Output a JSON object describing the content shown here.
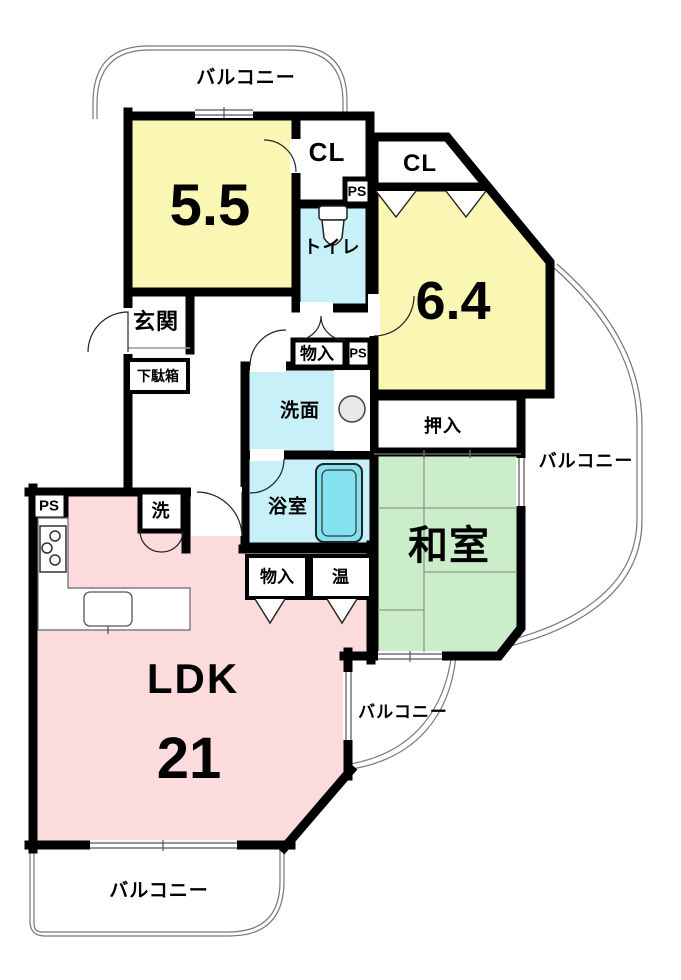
{
  "colors": {
    "room_yellow": "#FAF6B4",
    "room_cyan": "#C7F0F8",
    "room_green": "#CBEDCA",
    "room_pink": "#FBDBDB",
    "tub_cyan": "#84E1EF",
    "appliance_gray": "#E8E8E8",
    "wall_black": "#000000",
    "outline_gray": "#777777"
  },
  "labels": {
    "balcony_top": "バルコニー",
    "balcony_right": "バルコニー",
    "balcony_mid": "バルコニー",
    "balcony_bottom": "バルコニー",
    "room_5_5": "5.5",
    "room_6_4": "6.4",
    "cl_1": "CL",
    "cl_2": "CL",
    "ps_top": "PS",
    "ps_hall": "PS",
    "ps_kitchen": "PS",
    "toilet": "トイレ",
    "genkan": "玄関",
    "getabako": "下駄箱",
    "monoire_hall": "物入",
    "senmen": "洗面",
    "oshiire": "押入",
    "yokushitsu": "浴室",
    "washitsu": "和室",
    "laundry": "洗",
    "monoire_ldk": "物入",
    "water_heater": "温",
    "ldk": "LDK",
    "ldk_size": "21"
  }
}
